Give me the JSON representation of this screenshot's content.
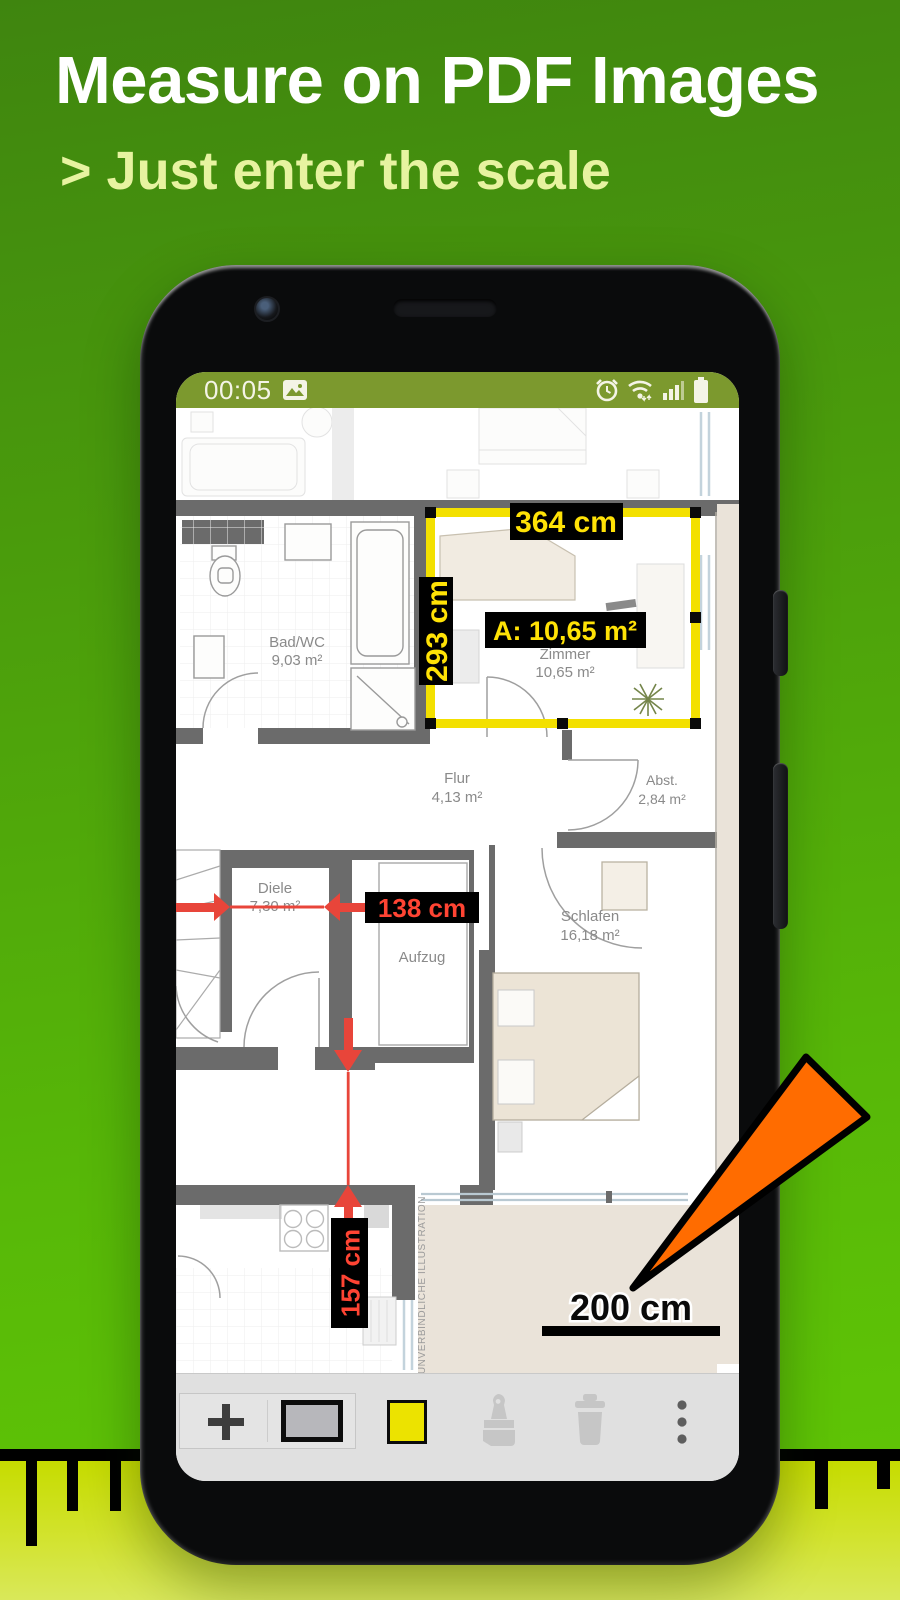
{
  "header": {
    "title": "Measure on PDF Images",
    "subtitle": "> Just enter the scale"
  },
  "statusbar": {
    "time": "00:05",
    "icons": [
      "photo-icon",
      "alarm-icon",
      "wifi-icon",
      "signal-icon",
      "battery-icon"
    ]
  },
  "floorplan": {
    "rooms": [
      {
        "name": "Bad/WC",
        "area": "9,03 m²"
      },
      {
        "name": "Zimmer",
        "area": "10,65 m²"
      },
      {
        "name": "Flur",
        "area": "4,13 m²"
      },
      {
        "name": "Abst.",
        "area": "2,84 m²"
      },
      {
        "name": "Diele",
        "area": "7,30 m²"
      },
      {
        "name": "Schlafen",
        "area": "16,18 m²"
      },
      {
        "name": "Aufzug",
        "area": ""
      }
    ],
    "measurements": {
      "width_label": "364 cm",
      "height_label": "293 cm",
      "area_label": "A: 10,65 m²",
      "hall_width": "138 cm",
      "kitchen_width": "157 cm"
    },
    "scale_label": "200 cm",
    "watermark": "UNVERBINDLICHE ILLUSTRATION"
  },
  "toolbar": {
    "buttons": [
      "add",
      "rectangle-tool",
      "color-yellow",
      "paint-tool",
      "delete-tool",
      "overflow-menu"
    ]
  },
  "colors": {
    "accent_yellow": "#ffe206",
    "selection_yellow": "#f3e000",
    "measure_red": "#e8453a",
    "pointer_orange": "#ff6c00",
    "statusbar_green": "#7c992e",
    "hero_green_top": "#3f850f",
    "ruler_yellow": "#c6dc00"
  }
}
